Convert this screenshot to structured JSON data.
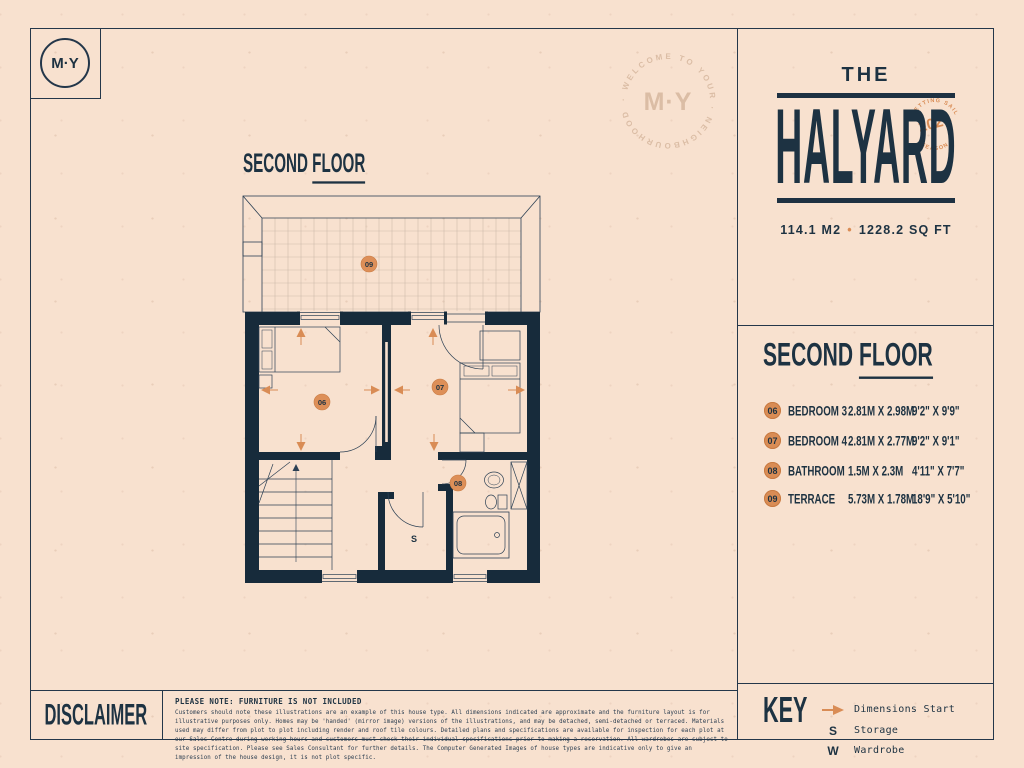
{
  "colors": {
    "background": "#f8e1cf",
    "navy": "#1d3242",
    "orange": "#d98c55",
    "tan": "#d6b79e"
  },
  "brand": {
    "logo": "M·Y"
  },
  "watermark": {
    "arc_text": "· WELCOME TO YOUR · NEIGHBOURHOOD",
    "center": "M·Y"
  },
  "title_panel": {
    "prefix": "THE",
    "name": "HALYARD",
    "stamp": {
      "year": "2024",
      "arc_top": "SETTING SAIL",
      "arc_bottom": "SEASON"
    },
    "area_metric": "114.1 M2",
    "area_sep": "•",
    "area_imperial": "1228.2 SQ FT"
  },
  "plan": {
    "heading_word1": "SECOND",
    "heading_word2": "FLOOR",
    "labels": {
      "bedroom3": "06",
      "bedroom4": "07",
      "bathroom": "08",
      "terrace": "09",
      "storage": "S"
    }
  },
  "rooms": {
    "heading_word1": "SECOND",
    "heading_word2": "FLOOR",
    "items": [
      {
        "num": "06",
        "name": "BEDROOM 3",
        "metric": "2.81M X 2.98M",
        "imperial": "9'2\" X 9'9\""
      },
      {
        "num": "07",
        "name": "BEDROOM 4",
        "metric": "2.81M X 2.77M",
        "imperial": "9'2\" X 9'1\""
      },
      {
        "num": "08",
        "name": "BATHROOM",
        "metric": "1.5M X 2.3M",
        "imperial": "4'11\" X 7'7\""
      },
      {
        "num": "09",
        "name": "TERRACE",
        "metric": "5.73M X 1.78M",
        "imperial": "18'9\" X 5'10\""
      }
    ]
  },
  "key": {
    "heading": "KEY",
    "items": [
      {
        "icon": "dimensions-arrow",
        "label": "Dimensions Start"
      },
      {
        "symbol": "S",
        "label": "Storage"
      },
      {
        "symbol": "W",
        "label": "Wardrobe"
      }
    ]
  },
  "disclaimer": {
    "heading": "DISCLAIMER",
    "note": "PLEASE NOTE: FURNITURE IS NOT INCLUDED",
    "body": "Customers should note these illustrations are an example of this house type. All dimensions indicated are approximate and the furniture layout is for illustrative purposes only. Homes may be 'handed' (mirror image) versions of the illustrations, and may be detached, semi-detached or terraced. Materials used may differ from plot to plot including render and roof tile colours. Detailed plans and specifications are available for inspection for each plot at our Sales Centre during working hours and customers must check their individual specifications prior to making a reservation. All wardrobes are subject to site specification. Please see Sales Consultant for further details. The Computer Generated Images of house types are indicative only to give an impression of the house design, it is not plot specific."
  }
}
